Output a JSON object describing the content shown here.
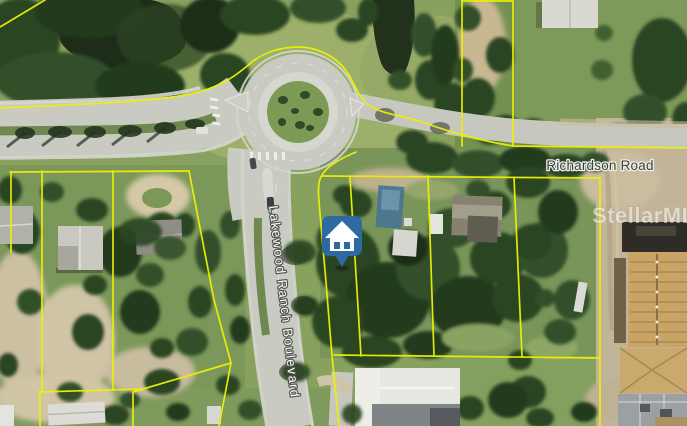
{
  "map": {
    "road_labels": {
      "richardson": "Richardson Road",
      "lakewood_ranch": "Lakewood Ranch Boulevard"
    },
    "watermark": "StellarMLS",
    "marker": {
      "icon": "home-marker",
      "color": "#2d6aa0",
      "glyph_color": "#ffffff"
    },
    "parcel_line_color": "#eef005"
  }
}
